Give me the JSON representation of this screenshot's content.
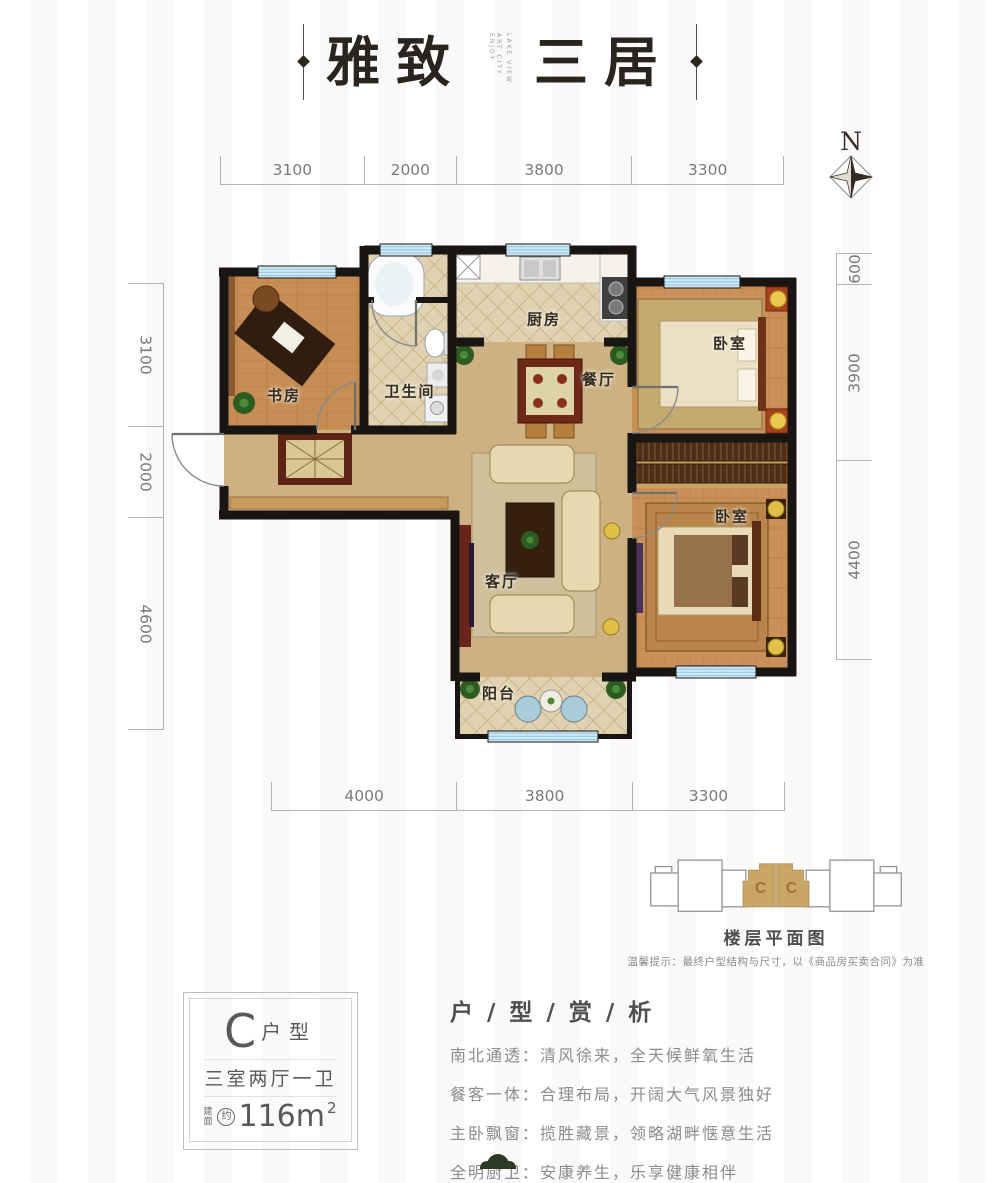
{
  "title": {
    "main_left": "雅致",
    "main_right": "三居",
    "sub_line1": "ART CITY ENJOY",
    "sub_line2": "LAKE VIEW"
  },
  "compass": {
    "label": "N"
  },
  "dimensions": {
    "top": [
      "3100",
      "2000",
      "3800",
      "3300"
    ],
    "bottom": [
      "4000",
      "3800",
      "3300"
    ],
    "left": [
      "3100",
      "2000",
      "4600"
    ],
    "right": [
      "600",
      "3900",
      "4400"
    ]
  },
  "rooms": {
    "study": "书房",
    "bathroom": "卫生间",
    "kitchen": "厨房",
    "dining": "餐厅",
    "bedroom_north": "卧室",
    "bedroom_south": "卧室",
    "living": "客厅",
    "balcony": "阳台"
  },
  "floorplate": {
    "caption": "楼层平面图",
    "note": "温馨提示：最终户型结构与尺寸，以《商品房买卖合同》为准",
    "unit_label": "C"
  },
  "unit_card": {
    "type_letter": "C",
    "type_suffix": "户型",
    "layout": "三室两厅一卫",
    "area_prefix": "建面",
    "area_circle": "约",
    "area_value": "116m",
    "area_sup": "2"
  },
  "analysis": {
    "title": "户 / 型 / 赏 / 析",
    "items": [
      "南北通透：清风徐来，全天候鲜氧生活",
      "餐客一体：合理布局，开阔大气风景独好",
      "主卧飘窗：揽胜藏景，领略湖畔惬意生活",
      "全明厨卫：安康养生，乐享健康相伴"
    ]
  },
  "colors": {
    "wall": "#181512",
    "window_blue": "#cfe9f7",
    "wood": "#c68d55",
    "marble": "#cdb183",
    "tile": "#e0d2b0",
    "accent_tan": "#c9a567"
  }
}
